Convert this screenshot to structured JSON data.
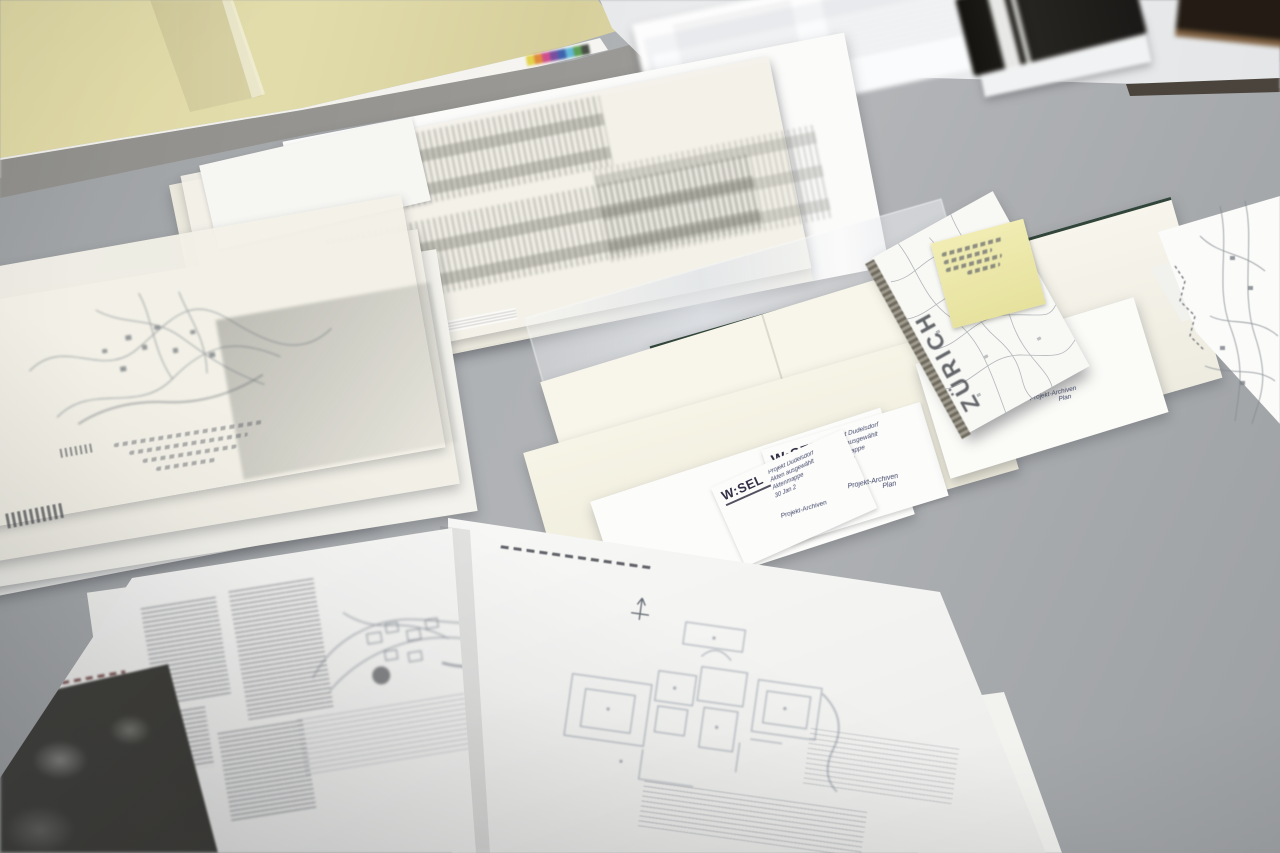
{
  "scene": {
    "name": "Architect's desk with plans, maps and envelopes"
  },
  "zurich_map": {
    "title": "ZÜRICH"
  },
  "wesel_labels": {
    "logo": "W:SEL",
    "label1_lines": [
      "Projekt Dudelsdorf",
      "Akten ausgewählt",
      "Aktenmappe",
      "30 Jan 2"
    ],
    "label2_lines": [
      "Projekt Dudelsdorf",
      "Akten ausgewählt",
      "Aktenmappe",
      "30 Jan 2"
    ],
    "label3_lines": [
      "Projekt Dudelsdorf",
      "Aktenmappe",
      "30 Jan 2"
    ]
  },
  "handwritten_notes": {
    "note1_line1": "Projekt-Archiven",
    "note1_line2": "Plan",
    "note2": "Projekt-Archiven",
    "note3_line1": "Projekt-Archiven",
    "note3_line2": "Plan"
  },
  "colors": {
    "wall": "#e2dcab",
    "table": "#aeb1b4",
    "envelope_cream": "#f8f6ea",
    "envelope_edge_green": "#31453a",
    "postit_yellow": "#ece7a8",
    "logo_ink": "#352f47"
  },
  "color_calibration_strip": [
    "#e3d24b",
    "#e08a3c",
    "#cf4f8e",
    "#7a4fa0",
    "#3f63ae",
    "#63b8d8",
    "#5d9e53",
    "#494f46"
  ]
}
